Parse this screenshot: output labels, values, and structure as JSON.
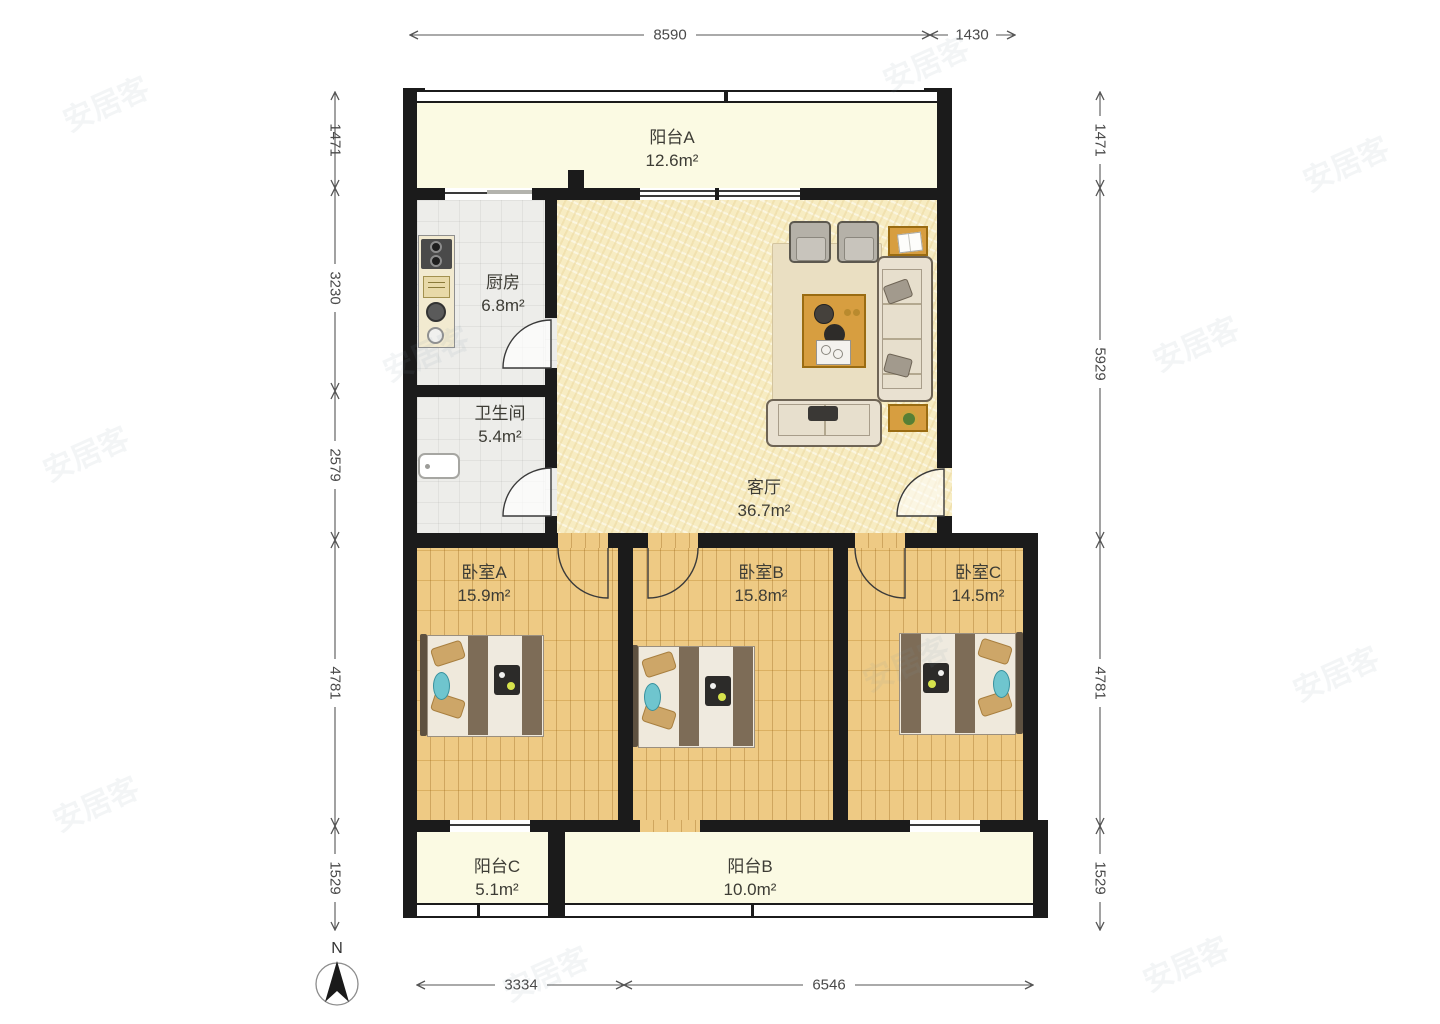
{
  "watermark": {
    "text": "安居客"
  },
  "compass": {
    "label": "N"
  },
  "rooms": {
    "balcony_a": {
      "name": "阳台A",
      "area": "12.6m²"
    },
    "kitchen": {
      "name": "厨房",
      "area": "6.8m²"
    },
    "bathroom": {
      "name": "卫生间",
      "area": "5.4m²"
    },
    "living": {
      "name": "客厅",
      "area": "36.7m²"
    },
    "bedroom_a": {
      "name": "卧室A",
      "area": "15.9m²"
    },
    "bedroom_b": {
      "name": "卧室B",
      "area": "15.8m²"
    },
    "bedroom_c": {
      "name": "卧室C",
      "area": "14.5m²"
    },
    "balcony_c": {
      "name": "阳台C",
      "area": "5.1m²"
    },
    "balcony_b": {
      "name": "阳台B",
      "area": "10.0m²"
    }
  },
  "dimensions": {
    "top": [
      "8590",
      "1430"
    ],
    "left": [
      "1471",
      "3230",
      "2579",
      "4781",
      "1529"
    ],
    "right": [
      "1471",
      "5929",
      "4781",
      "1529"
    ],
    "bottom": [
      "3334",
      "6546"
    ]
  },
  "legend": {
    "furniture": [
      "sofa",
      "armchair",
      "loveseat",
      "coffee-table",
      "side-table",
      "rug",
      "bed",
      "stove",
      "sink",
      "counter",
      "bathtub",
      "plant",
      "book"
    ]
  },
  "colors": {
    "wall": "#1b1b1b",
    "wood": "#ecc373",
    "balcony": "#fbfae3",
    "living": "#f7ecc2",
    "tile": "#ededea",
    "table_accent": "#d79e40"
  }
}
